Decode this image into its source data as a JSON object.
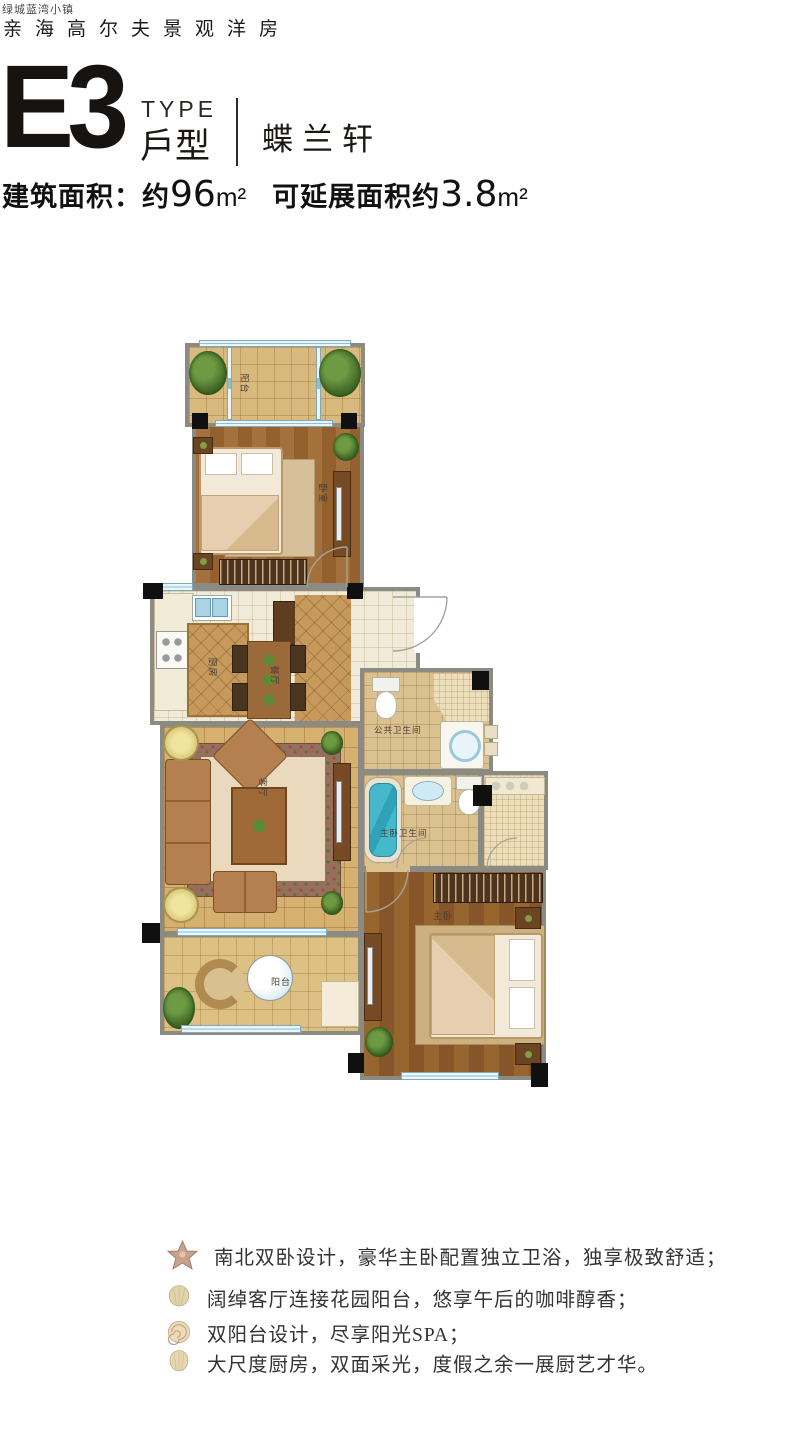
{
  "header": {
    "brand_small": "绿城蓝湾小镇",
    "brand_main": "亲海高尔夫景观洋房",
    "type_code": "E3",
    "type_en": "TYPE",
    "type_cn": "戶型",
    "unit_name": "蝶兰轩",
    "area": {
      "label1": "建筑面积：约",
      "value1": "96",
      "unit1": "m²",
      "label2": "可延展面积约",
      "value2": "3.8",
      "unit2": "m²"
    }
  },
  "floorplan": {
    "rooms": {
      "balcony_top": "阳台",
      "bedroom": "卧室",
      "kitchen": "厨房",
      "dining": "餐厅",
      "public_bath": "公共卫生间",
      "living": "客厅",
      "master_bath": "主卧卫生间",
      "master_bedroom": "主卧",
      "balcony_bottom": "阳台"
    }
  },
  "features": {
    "items": [
      {
        "icon": "starfish",
        "text": "南北双卧设计，豪华主卧配置独立卫浴，独享极致舒适；"
      },
      {
        "icon": "clam-shell",
        "text": "阔绰客厅连接花园阳台，悠享午后的咖啡醇香；"
      },
      {
        "icon": "spiral-shell",
        "text": "双阳台设计，尽享阳光SPA；"
      },
      {
        "icon": "scallop-shell",
        "text": "大尺度厨房，双面采光，度假之余一展厨艺才华。"
      }
    ]
  },
  "colors": {
    "wall": "#8b8b83",
    "column": "#101010",
    "window_blue": "#cfe6ef",
    "wood_floor": "#9a6836",
    "tile_floor": "#d8b97e",
    "water_blue": "#45b8cc"
  }
}
